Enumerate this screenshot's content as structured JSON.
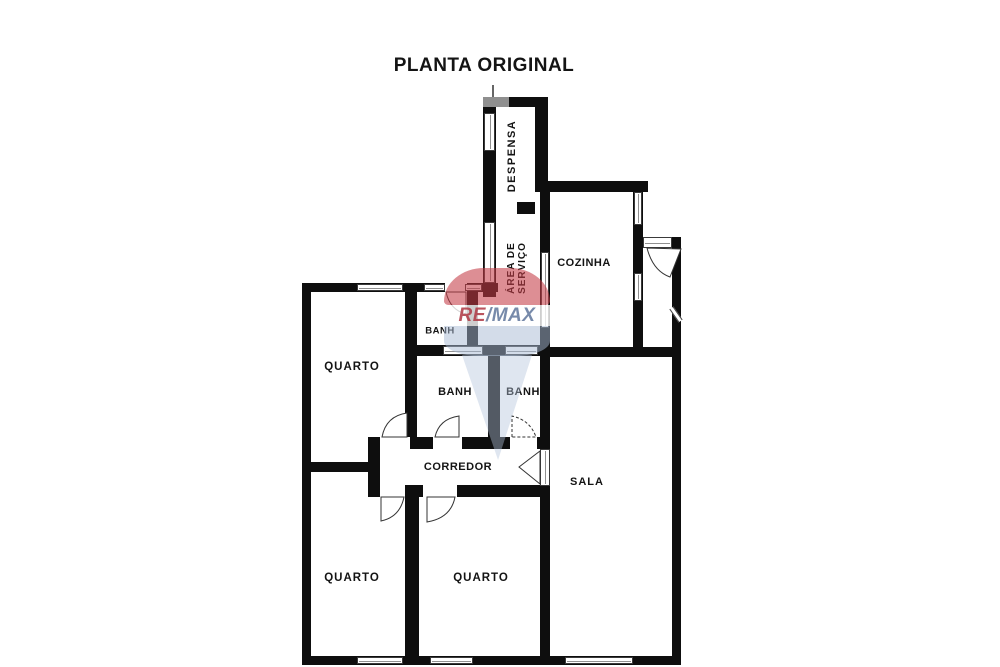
{
  "title": "PLANTA ORIGINAL",
  "watermark": {
    "re": "RE",
    "slash_max": "/MAX"
  },
  "colors": {
    "walls": "#0e0e0e",
    "background": "#ffffff",
    "top_corner_gray": "#8f8f8f",
    "watermark_red": "#c53c46",
    "watermark_blue": "#a8bad3",
    "watermark_text_red": "#b03c48",
    "watermark_text_blue": "#647a9e"
  },
  "rooms": {
    "despensa": {
      "label": "DESPENSA"
    },
    "cozinha": {
      "label": "COZINHA"
    },
    "area_servico": {
      "line1": "ÁREA DE",
      "line2": "SERVIÇO"
    },
    "banh_top": {
      "label": "BANH"
    },
    "banh_left": {
      "label": "BANH"
    },
    "banh_right": {
      "label": "BANH"
    },
    "quarto_top_left": {
      "label": "QUARTO"
    },
    "quarto_bottom_left": {
      "label": "QUARTO"
    },
    "quarto_bottom_middle": {
      "label": "QUARTO"
    },
    "corredor": {
      "label": "CORREDOR"
    },
    "sala": {
      "label": "SALA"
    }
  }
}
